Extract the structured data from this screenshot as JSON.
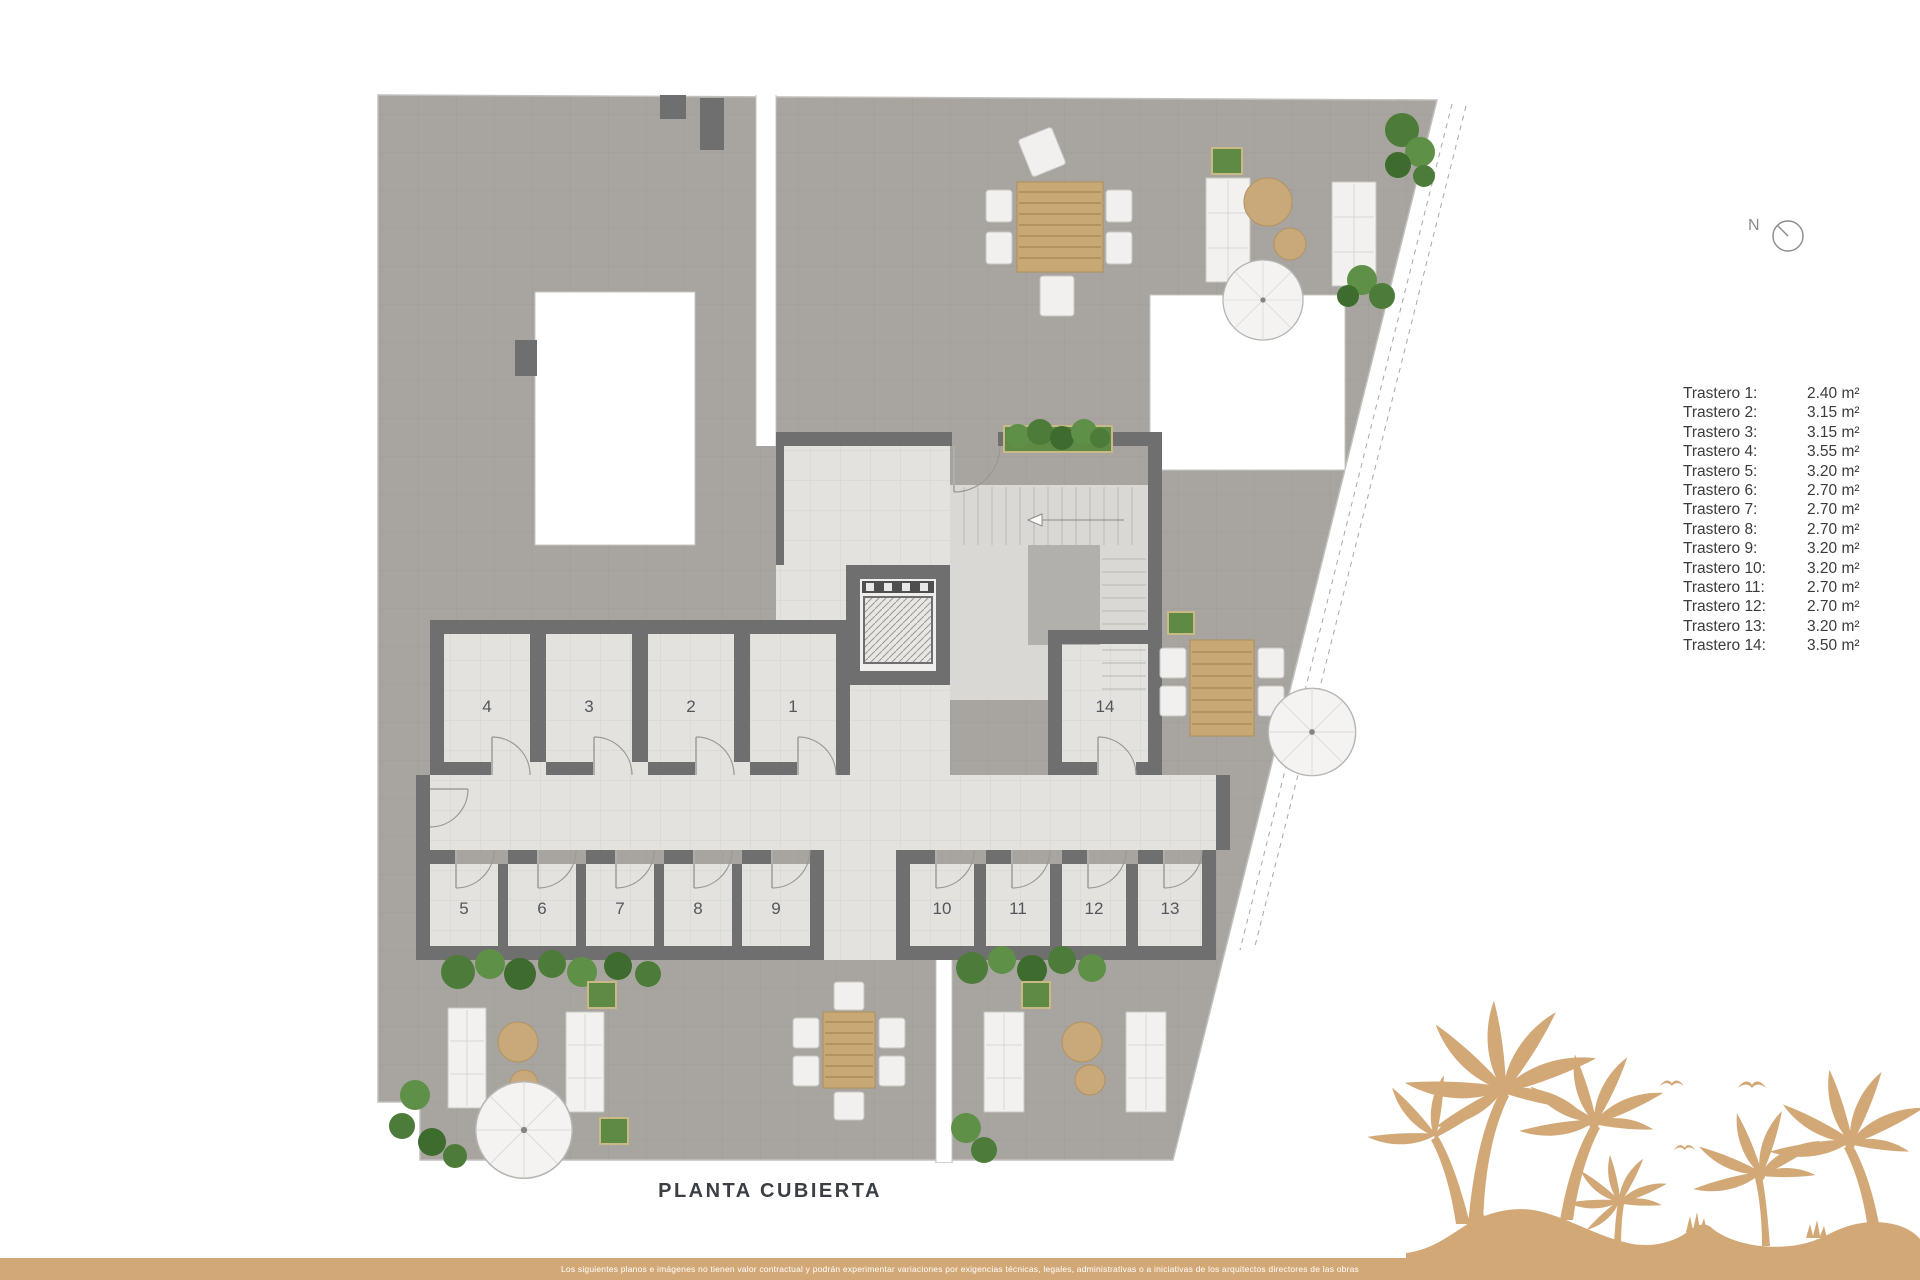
{
  "north": {
    "label": "N"
  },
  "plan": {
    "title": "PLANTA CUBIERTA",
    "room_numbers": [
      "1",
      "2",
      "3",
      "4",
      "5",
      "6",
      "7",
      "8",
      "9",
      "10",
      "11",
      "12",
      "13",
      "14"
    ]
  },
  "legend": {
    "rows": [
      {
        "label": "Trastero 1:",
        "value": "2.40 m²"
      },
      {
        "label": "Trastero 2:",
        "value": "3.15 m²"
      },
      {
        "label": "Trastero 3:",
        "value": "3.15 m²"
      },
      {
        "label": "Trastero 4:",
        "value": "3.55 m²"
      },
      {
        "label": "Trastero 5:",
        "value": "3.20 m²"
      },
      {
        "label": "Trastero 6:",
        "value": "2.70 m²"
      },
      {
        "label": "Trastero 7:",
        "value": "2.70 m²"
      },
      {
        "label": "Trastero 8:",
        "value": "2.70 m²"
      },
      {
        "label": "Trastero 9:",
        "value": "3.20 m²"
      },
      {
        "label": "Trastero 10:",
        "value": "3.20 m²"
      },
      {
        "label": "Trastero 11:",
        "value": "2.70 m²"
      },
      {
        "label": "Trastero 12:",
        "value": "2.70 m²"
      },
      {
        "label": "Trastero 13:",
        "value": "3.20 m²"
      },
      {
        "label": "Trastero 14:",
        "value": "3.50 m²"
      }
    ]
  },
  "footer": {
    "disclaimer": "Los siguientes planos e imágenes no tienen valor contractual y podrán experimentar variaciones por exigencias técnicas, legales, administrativas o a iniciativas de los arquitectos directores de las obras"
  },
  "colors": {
    "brand_tan": "#d3a877",
    "terrace_gray": "#a8a5a0",
    "wall_gray": "#6f6f6f",
    "floor_light": "#e3e2df",
    "plant_green": "#567f3e",
    "title_text": "#3b3f44"
  }
}
